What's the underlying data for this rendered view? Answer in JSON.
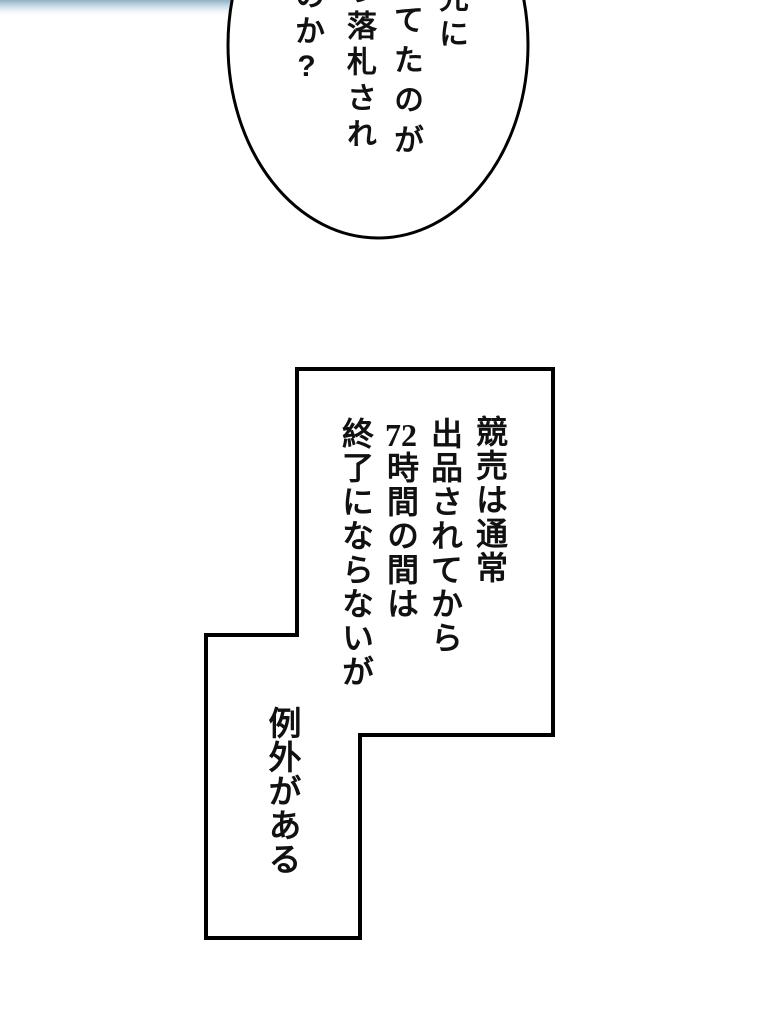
{
  "colors": {
    "ink": "#000000",
    "text_ink": "#111111",
    "paper": "#ffffff",
    "strip_top": "#8fb2c6",
    "strip_mid": "#c8dbe6",
    "strip_fade": "#f2f7fa"
  },
  "speech_bubble": {
    "line1": "先に",
    "line2": "してたのが",
    "line3": "う落札され",
    "line4": "のか?"
  },
  "caption_box": {
    "line1": "競売は通常",
    "line2": "出品されてから",
    "line3_number": "72",
    "line3_rest": "時間の間は",
    "line4": "終了にならないが"
  },
  "exception_caption": {
    "text": "例外がある"
  }
}
